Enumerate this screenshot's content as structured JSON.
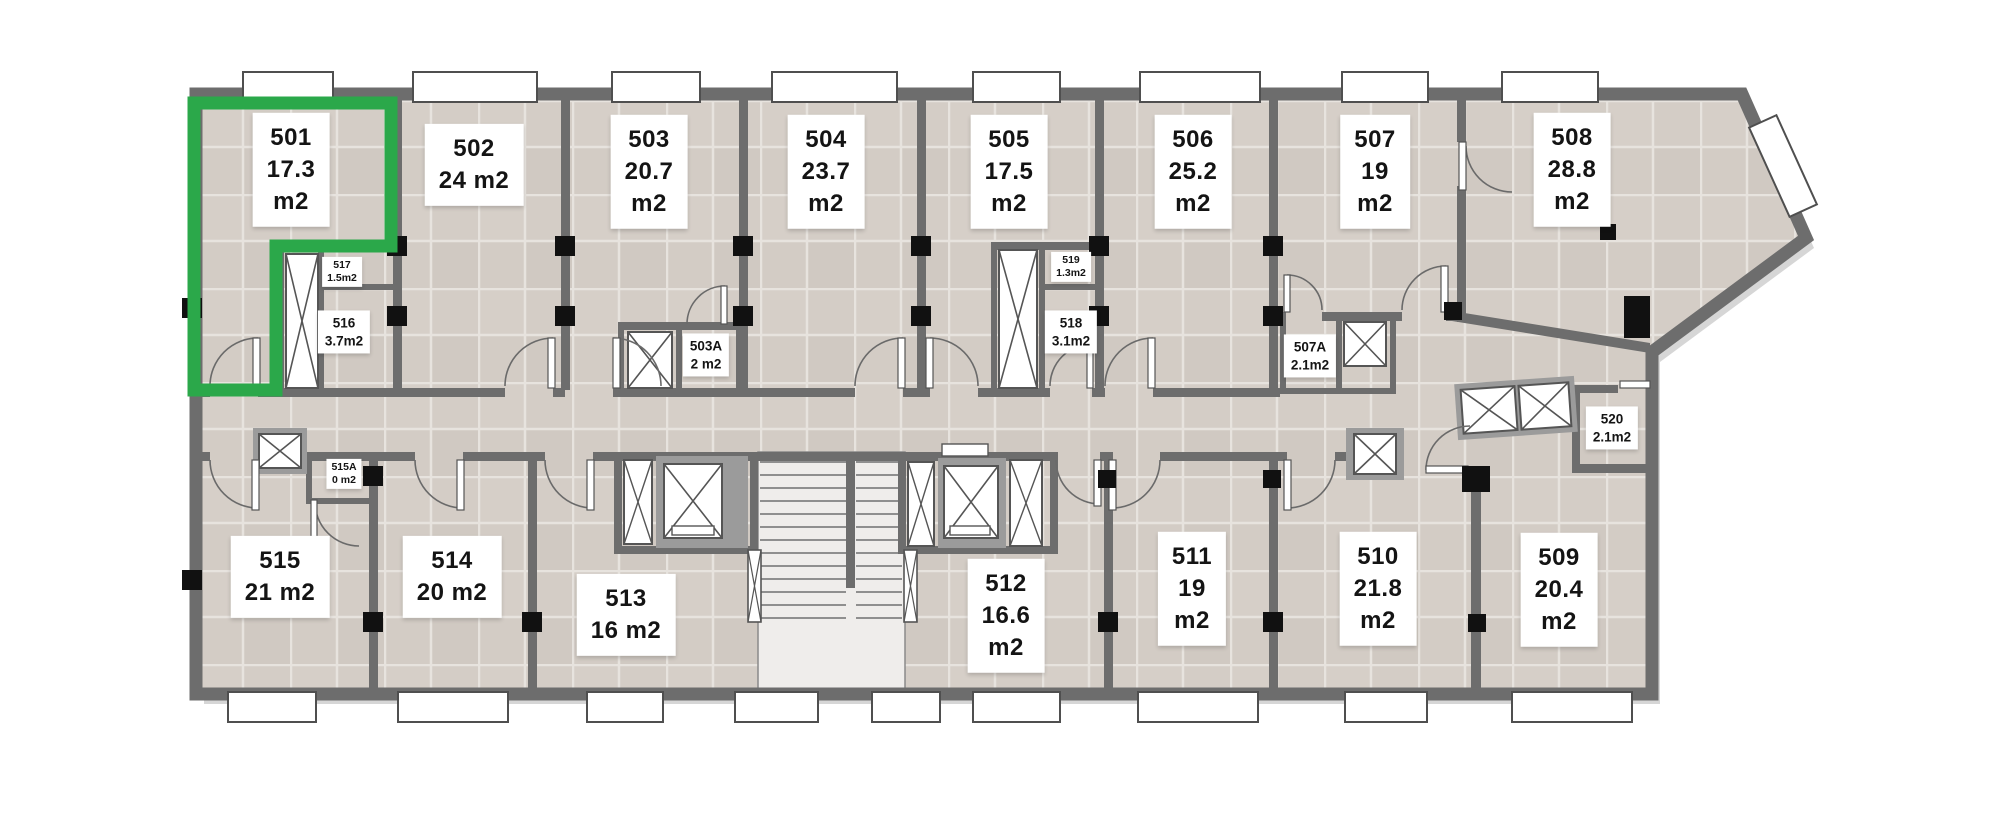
{
  "plan": {
    "name": "Floor plan – level 5",
    "selected_unit_id": "501",
    "colors": {
      "highlight_green": "#2BA84A",
      "wall_gray": "#6d6d6d",
      "floor_tile": "#d3ccc5",
      "tile_grout": "#e7e3de",
      "column_black": "#111111",
      "label_bg": "#ffffff",
      "label_text": "#141414",
      "stair_marble": "#efedeb"
    }
  },
  "units": [
    {
      "id": "501",
      "area": "17.3 m2",
      "highlighted": true,
      "lines": [
        "501",
        "17.3",
        "m2"
      ]
    },
    {
      "id": "502",
      "area": "24 m2",
      "highlighted": false,
      "lines": [
        "502",
        "24 m2"
      ]
    },
    {
      "id": "503",
      "area": "20.7 m2",
      "highlighted": false,
      "lines": [
        "503",
        "20.7",
        "m2"
      ]
    },
    {
      "id": "504",
      "area": "23.7 m2",
      "highlighted": false,
      "lines": [
        "504",
        "23.7",
        "m2"
      ]
    },
    {
      "id": "505",
      "area": "17.5 m2",
      "highlighted": false,
      "lines": [
        "505",
        "17.5",
        "m2"
      ]
    },
    {
      "id": "506",
      "area": "25.2 m2",
      "highlighted": false,
      "lines": [
        "506",
        "25.2",
        "m2"
      ]
    },
    {
      "id": "507",
      "area": "19 m2",
      "highlighted": false,
      "lines": [
        "507",
        "19",
        "m2"
      ]
    },
    {
      "id": "508",
      "area": "28.8 m2",
      "highlighted": false,
      "lines": [
        "508",
        "28.8",
        "m2"
      ]
    },
    {
      "id": "509",
      "area": "20.4 m2",
      "highlighted": false,
      "lines": [
        "509",
        "20.4",
        "m2"
      ]
    },
    {
      "id": "510",
      "area": "21.8 m2",
      "highlighted": false,
      "lines": [
        "510",
        "21.8",
        "m2"
      ]
    },
    {
      "id": "511",
      "area": "19 m2",
      "highlighted": false,
      "lines": [
        "511",
        "19",
        "m2"
      ]
    },
    {
      "id": "512",
      "area": "16.6 m2",
      "highlighted": false,
      "lines": [
        "512",
        "16.6",
        "m2"
      ]
    },
    {
      "id": "513",
      "area": "16 m2",
      "highlighted": false,
      "lines": [
        "513",
        "16 m2"
      ]
    },
    {
      "id": "514",
      "area": "20 m2",
      "highlighted": false,
      "lines": [
        "514",
        "20 m2"
      ]
    },
    {
      "id": "515",
      "area": "21 m2",
      "highlighted": false,
      "lines": [
        "515",
        "21 m2"
      ]
    },
    {
      "id": "503A",
      "area": "2 m2",
      "highlighted": false,
      "lines": [
        "503A",
        "2 m2"
      ]
    },
    {
      "id": "507A",
      "area": "2.1 m2",
      "highlighted": false,
      "lines": [
        "507A",
        "2.1m2"
      ]
    },
    {
      "id": "515A",
      "area": "0 m2",
      "highlighted": false,
      "lines": [
        "515A",
        "0 m2"
      ]
    },
    {
      "id": "516",
      "area": "3.7 m2",
      "highlighted": false,
      "lines": [
        "516",
        "3.7m2"
      ]
    },
    {
      "id": "517",
      "area": "1.5 m2",
      "highlighted": false,
      "lines": [
        "517",
        "1.5m2"
      ]
    },
    {
      "id": "518",
      "area": "3.1 m2",
      "highlighted": false,
      "lines": [
        "518",
        "3.1m2"
      ]
    },
    {
      "id": "519",
      "area": "1.3 m2",
      "highlighted": false,
      "lines": [
        "519",
        "1.3m2"
      ]
    },
    {
      "id": "520",
      "area": "2.1 m2",
      "highlighted": false,
      "lines": [
        "520",
        "2.1m2"
      ]
    }
  ]
}
